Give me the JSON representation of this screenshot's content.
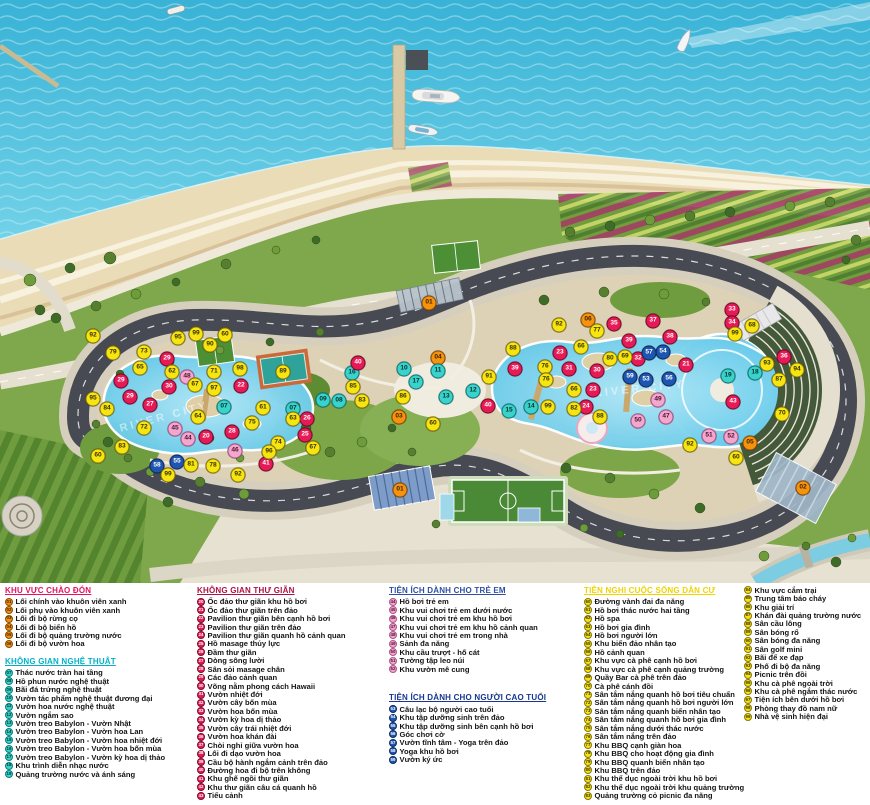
{
  "map": {
    "watermark": "RIVER CITY",
    "ranges": [
      {
        "from": 1,
        "to": 6,
        "bg": "#f5930f",
        "fg": "#3d2100",
        "br": "#8a4d00"
      },
      {
        "from": 7,
        "to": 19,
        "bg": "#3ad2cb",
        "fg": "#00332f",
        "br": "#0b7f7a"
      },
      {
        "from": 20,
        "to": 43,
        "bg": "#e51a56",
        "fg": "#ffffff",
        "br": "#7c0a2c"
      },
      {
        "from": 44,
        "to": 52,
        "bg": "#f2a7cd",
        "fg": "#541034",
        "br": "#b0538a"
      },
      {
        "from": 53,
        "to": 59,
        "bg": "#1d56b0",
        "fg": "#ffffff",
        "br": "#0d2a60"
      },
      {
        "from": 60,
        "to": 99,
        "bg": "#f6e511",
        "fg": "#3a3000",
        "br": "#86770a"
      }
    ],
    "markers": [
      [
        "01",
        429,
        303
      ],
      [
        "01",
        400,
        490
      ],
      [
        "02",
        803,
        488
      ],
      [
        "03",
        399,
        417
      ],
      [
        "04",
        438,
        358
      ],
      [
        "05",
        750,
        443
      ],
      [
        "06",
        588,
        320
      ],
      [
        "07",
        224,
        407
      ],
      [
        "07",
        293,
        409
      ],
      [
        "08",
        339,
        401
      ],
      [
        "09",
        323,
        400
      ],
      [
        "10",
        404,
        369
      ],
      [
        "11",
        438,
        371
      ],
      [
        "12",
        473,
        391
      ],
      [
        "13",
        446,
        397
      ],
      [
        "14",
        531,
        407
      ],
      [
        "15",
        509,
        411
      ],
      [
        "16",
        352,
        373
      ],
      [
        "17",
        416,
        382
      ],
      [
        "18",
        755,
        373
      ],
      [
        "19",
        728,
        376
      ],
      [
        "20",
        206,
        437
      ],
      [
        "21",
        686,
        365
      ],
      [
        "22",
        241,
        386
      ],
      [
        "23",
        560,
        353
      ],
      [
        "23",
        593,
        390
      ],
      [
        "24",
        586,
        407
      ],
      [
        "25",
        305,
        435
      ],
      [
        "26",
        307,
        419
      ],
      [
        "27",
        150,
        405
      ],
      [
        "28",
        232,
        432
      ],
      [
        "29",
        167,
        359
      ],
      [
        "29",
        121,
        381
      ],
      [
        "29",
        130,
        397
      ],
      [
        "30",
        169,
        387
      ],
      [
        "30",
        597,
        371
      ],
      [
        "31",
        569,
        369
      ],
      [
        "32",
        638,
        359
      ],
      [
        "33",
        732,
        310
      ],
      [
        "34",
        732,
        323
      ],
      [
        "35",
        614,
        324
      ],
      [
        "36",
        784,
        357
      ],
      [
        "37",
        653,
        321
      ],
      [
        "38",
        670,
        337
      ],
      [
        "39",
        629,
        341
      ],
      [
        "39",
        515,
        369
      ],
      [
        "40",
        358,
        363
      ],
      [
        "40",
        488,
        406
      ],
      [
        "41",
        266,
        464
      ],
      [
        "43",
        733,
        402
      ],
      [
        "44",
        188,
        439
      ],
      [
        "45",
        175,
        429
      ],
      [
        "46",
        235,
        451
      ],
      [
        "47",
        666,
        417
      ],
      [
        "48",
        187,
        377
      ],
      [
        "49",
        658,
        400
      ],
      [
        "50",
        638,
        421
      ],
      [
        "51",
        709,
        436
      ],
      [
        "52",
        731,
        437
      ],
      [
        "53",
        646,
        380
      ],
      [
        "54",
        663,
        352
      ],
      [
        "55",
        177,
        462
      ],
      [
        "56",
        669,
        379
      ],
      [
        "57",
        649,
        353
      ],
      [
        "58",
        157,
        466
      ],
      [
        "59",
        630,
        377
      ],
      [
        "60",
        225,
        335
      ],
      [
        "60",
        98,
        456
      ],
      [
        "60",
        433,
        424
      ],
      [
        "60",
        736,
        458
      ],
      [
        "61",
        263,
        408
      ],
      [
        "62",
        172,
        372
      ],
      [
        "63",
        293,
        419
      ],
      [
        "64",
        198,
        417
      ],
      [
        "65",
        140,
        368
      ],
      [
        "66",
        581,
        347
      ],
      [
        "66",
        574,
        390
      ],
      [
        "67",
        195,
        385
      ],
      [
        "67",
        313,
        448
      ],
      [
        "68",
        752,
        326
      ],
      [
        "69",
        625,
        357
      ],
      [
        "70",
        782,
        414
      ],
      [
        "71",
        214,
        372
      ],
      [
        "72",
        144,
        428
      ],
      [
        "73",
        144,
        352
      ],
      [
        "74",
        278,
        443
      ],
      [
        "75",
        252,
        423
      ],
      [
        "76",
        545,
        367
      ],
      [
        "76",
        546,
        380
      ],
      [
        "77",
        597,
        331
      ],
      [
        "78",
        213,
        466
      ],
      [
        "79",
        113,
        353
      ],
      [
        "80",
        610,
        359
      ],
      [
        "81",
        191,
        465
      ],
      [
        "82",
        574,
        409
      ],
      [
        "83",
        122,
        447
      ],
      [
        "83",
        362,
        401
      ],
      [
        "84",
        107,
        409
      ],
      [
        "85",
        353,
        387
      ],
      [
        "86",
        403,
        397
      ],
      [
        "87",
        779,
        380
      ],
      [
        "88",
        513,
        349
      ],
      [
        "88",
        600,
        417
      ],
      [
        "89",
        283,
        372
      ],
      [
        "90",
        210,
        345
      ],
      [
        "91",
        489,
        377
      ],
      [
        "92",
        93,
        336
      ],
      [
        "92",
        559,
        325
      ],
      [
        "92",
        238,
        475
      ],
      [
        "92",
        690,
        445
      ],
      [
        "93",
        767,
        364
      ],
      [
        "94",
        797,
        370
      ],
      [
        "95",
        178,
        338
      ],
      [
        "95",
        93,
        399
      ],
      [
        "96",
        269,
        452
      ],
      [
        "97",
        214,
        389
      ],
      [
        "98",
        240,
        369
      ],
      [
        "99",
        196,
        334
      ],
      [
        "99",
        735,
        334
      ],
      [
        "99",
        548,
        407
      ],
      [
        "99",
        168,
        475
      ]
    ]
  },
  "legend": {
    "columns": [
      {
        "x": 5,
        "w": 188,
        "sections": [
          "welcome",
          "art"
        ]
      },
      {
        "x": 197,
        "w": 188,
        "sections": [
          "relax"
        ]
      },
      {
        "x": 389,
        "w": 190,
        "sections": [
          "kids",
          "elderly"
        ]
      },
      {
        "x": 584,
        "w": 156,
        "sections": [
          "community"
        ]
      },
      {
        "x": 744,
        "w": 124,
        "sections": [
          "community2"
        ]
      }
    ],
    "sections": {
      "welcome": {
        "title": "KHU VỰC CHÀO ĐÓN",
        "color": "#e4125f",
        "start": 1,
        "gap": 0,
        "items": [
          "Lối chính vào khuôn viên xanh",
          "Lối phụ vào khuôn viên xanh",
          "Lối đi bộ rừng cọ",
          "Lối đi bộ biển hồ",
          "Lối đi bộ quảng trường nước",
          "Lối đi bộ vườn hoa"
        ]
      },
      "art": {
        "title": "KHÔNG GIAN NGHỆ THUẬT",
        "color": "#00b2c8",
        "start": 7,
        "gap": 9,
        "items": [
          "Thác nước tràn hai tầng",
          "Hồ phun nước nghệ thuật",
          "Bãi đá trứng nghệ thuật",
          "Vườn tác phẩm nghệ thuật đương đại",
          "Vườn hoa nước nghệ thuật",
          "Vườn ngắm sao",
          "Vườn treo Babylon - Vườn Nhật",
          "Vườn treo Babylon - Vườn hoa Lan",
          "Vườn treo Babylon - Vườn hoa nhiệt đới",
          "Vườn treo Babylon - Vườn hoa bốn mùa",
          "Vườn treo Babylon - Vườn kỳ hoa dị thảo",
          "Khu trình diễn nhạc nước",
          "Quảng trường nước và ánh sáng"
        ]
      },
      "relax": {
        "title": "KHÔNG GIAN THƯ GIÃN",
        "color": "#b01043",
        "start": 20,
        "gap": 0,
        "items": [
          "Ốc đảo thư giãn khu hồ bơi",
          "Ốc đảo thư giãn trên đảo",
          "Pavilion thư giãn bên cạnh hồ bơi",
          "Pavilion thư giãn trên đảo",
          "Pavilion thư giãn quanh hồ cảnh quan",
          "Hồ masage thủy lực",
          "Đầm thư giãn",
          "Dòng sông lười",
          "Sân sỏi masage chân",
          "Các đảo cảnh quan",
          "Võng nằm phong cách Hawaii",
          "Vườn nhiệt đới",
          "Vườn cây bốn mùa",
          "Vườn hoa bốn mùa",
          "Vườn kỳ hoa dị thảo",
          "Vườn cây trái nhiệt đới",
          "Vườn hoa khán đài",
          "Chòi nghỉ giữa vườn hoa",
          "Lối đi dạo vườn hoa",
          "Cầu bộ hành ngắm cảnh trên đảo",
          "Đường hoa đi bộ trên không",
          "Khu ghế ngồi thư giãn",
          "Khu thư giãn câu cá quanh hồ",
          "Tiểu cảnh"
        ]
      },
      "kids": {
        "title": "TIỆN ÍCH DÀNH CHO TRẺ EM",
        "color": "#2e4fa5",
        "start": 44,
        "gap": 0,
        "items": [
          "Hồ bơi trẻ em",
          "Khu vui chơi trẻ em dưới nước",
          "Khu vui chơi trẻ em khu hồ bơi",
          "Khu vui chơi trẻ em khu hồ cảnh quan",
          "Khu vui chơi trẻ em trong nhà",
          "Sảnh đa năng",
          "Khu cầu trượt - hố cát",
          "Tường tập leo núi",
          "Khu vườn mê cung"
        ]
      },
      "elderly": {
        "title": "TIỆN ÍCH DÀNH CHO NGƯỜI CAO TUỔI",
        "color": "#16368f",
        "start": 53,
        "gap": 20,
        "items": [
          "Câu lạc bộ người cao tuổi",
          "Khu tập dưỡng sinh trên đảo",
          "Khu tập dưỡng sinh bên cạnh hồ bơi",
          "Góc chơi cờ",
          "Vườn tĩnh tâm - Yoga trên đảo",
          "Yoga khu hồ bơi",
          "Vườn ký ức"
        ]
      },
      "community": {
        "title": "TIỆN NGHI CUỘC SỐNG DÂN CƯ",
        "color": "#f0d400",
        "start": 60,
        "gap": 0,
        "items": [
          "Đường vành đai đa năng",
          "Hồ bơi thác nước hai tầng",
          "Hồ spa",
          "Hồ bơi gia đình",
          "Hồ bơi người lớn",
          "Khu biển đảo nhân tạo",
          "Hồ cảnh quan",
          "Khu vực cà phê cạnh hồ bơi",
          "Khu vực cà phê cạnh quảng trường",
          "Quầy Bar cà phê trên đảo",
          "Cà phê cánh đồi",
          "Sân tắm nắng quanh hồ bơi tiêu chuẩn",
          "Sân tắm nắng quanh hồ bơi người lớn",
          "Sân tắm nắng quanh biển nhân tạo",
          "Sân tắm nắng quanh hồ bơi gia đình",
          "Sân tắm nắng dưới thác nước",
          "Sân tắm nắng  trên đảo",
          "Khu BBQ cạnh giàn hoa",
          "Khu BBQ cho hoạt động gia đình",
          "Khu BBQ quanh biển nhân tạo",
          "Khu BBQ trên đảo",
          "Khu thể dục ngoài trời khu hồ bơi",
          "Khu thể dục ngoài trời khu quảng trường",
          "Quảng trường cỏ picnic đa năng"
        ]
      },
      "community2": {
        "title": null,
        "color": "#f0d400",
        "start": 84,
        "gap": 0,
        "items": [
          "Khu vực cắm trại",
          "Trung tâm báo cháy",
          "Khu giải trí",
          "Khán đài quảng trường nước",
          "Sân cầu lông",
          "Sân bóng rổ",
          "Sân bóng đa năng",
          "Sân golf mini",
          "Bãi để xe đạp",
          "Phố đi bộ đa năng",
          "Picnic trên đồi",
          "Khu cà phê ngoài trời",
          "Khu cà phê ngắm thác nước",
          "Tiện ích bên dưới hồ bơi",
          "Phòng thay đồ nam nữ",
          "Nhà vệ sinh hiện đại"
        ]
      }
    }
  }
}
